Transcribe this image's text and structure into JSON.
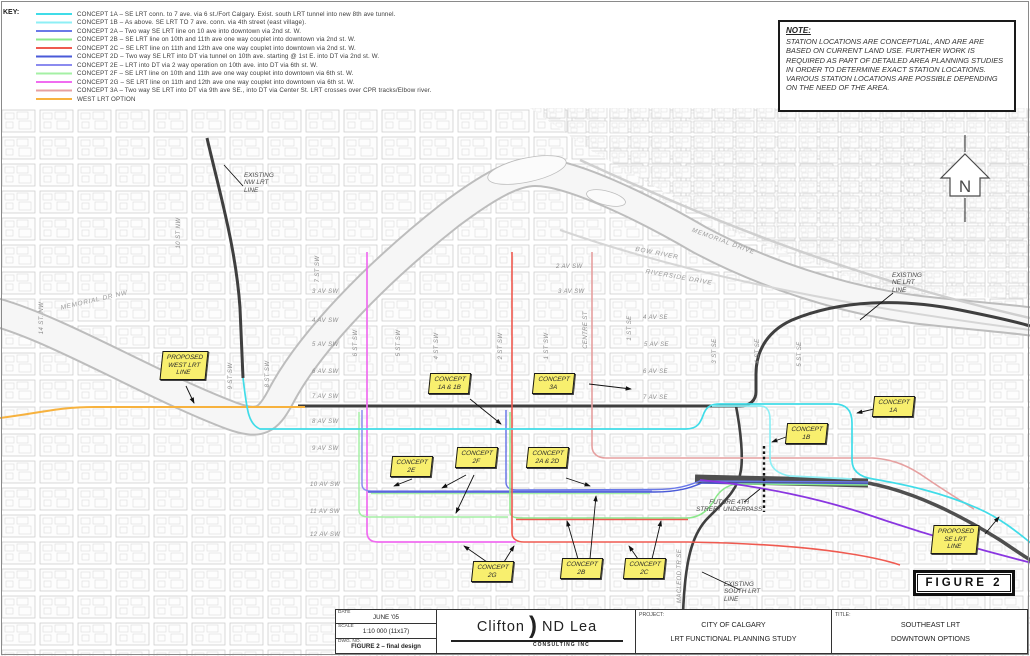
{
  "key": {
    "title": "KEY:",
    "items": [
      {
        "id": "1A",
        "color": "#40DCE8",
        "label": "CONCEPT 1A – SE LRT conn. to 7 ave. via 6 st./Fort Calgary. Exist. south LRT tunnel into new 8th ave tunnel."
      },
      {
        "id": "1B",
        "color": "#8EEFF5",
        "label": "CONCEPT 1B – As above. SE LRT TO 7 ave. conn. via 4th street (east village)."
      },
      {
        "id": "2A",
        "color": "#6A79E8",
        "label": "CONCEPT 2A – Two way SE LRT line on 10 ave into downtown via 2nd st. W."
      },
      {
        "id": "2B",
        "color": "#8BE88B",
        "label": "CONCEPT 2B – SE LRT line on 10th and 11th ave one way couplet into downtown via 2nd st. W."
      },
      {
        "id": "2C",
        "color": "#EF5A50",
        "label": "CONCEPT 2C – SE LRT line on 11th and 12th ave one way couplet into downtown via 2nd st. W."
      },
      {
        "id": "2D",
        "color": "#4A5AD8",
        "label": "CONCEPT 2D – Two way SE LRT into DT via tunnel on 10th ave. starting @ 1st E. into DT via 2nd st. W."
      },
      {
        "id": "2E",
        "color": "#8B8BEF",
        "label": "CONCEPT 2E – LRT into DT via 2 way operation on 10th ave. into DT via 6th st. W."
      },
      {
        "id": "2F",
        "color": "#A5F0A5",
        "label": "CONCEPT 2F – SE LRT line on 10th and 11th ave one way couplet into downtown via 6th st. W."
      },
      {
        "id": "2G",
        "color": "#F06CF0",
        "label": "CONCEPT 2G – SE LRT line on 11th and 12th ave one way couplet into downtown via 6th st. W."
      },
      {
        "id": "3A",
        "color": "#E6A0A0",
        "label": "CONCEPT 3A – Two way SE LRT into DT via 9th ave SE., into DT via Center St.  LRT crosses over CPR tracks/Elbow river."
      },
      {
        "id": "WEST",
        "color": "#F7B23E",
        "label": "WEST LRT OPTION"
      }
    ]
  },
  "note": {
    "title": "NOTE:",
    "body": "STATION LOCATIONS ARE CONCEPTUAL, AND ARE ARE BASED ON CURRENT LAND USE. FURTHER WORK IS REQUIRED AS PART OF DETAILED AREA PLANNING STUDIES IN ORDER TO DETERMINE EXACT STATION LOCATIONS. VARIOUS STATION LOCATIONS ARE POSSIBLE DEPENDING ON THE NEED OF THE AREA."
  },
  "north": {
    "letter": "N"
  },
  "map": {
    "colors": {
      "existing": "#3f3f3f",
      "cpr_band": "#4f4f4f",
      "se_line": "#8A36E0",
      "dotted": "#111111"
    },
    "figure_label": "FIGURE 2",
    "avenues_sw": [
      "3 AV SW",
      "4 AV SW",
      "5 AV SW",
      "6 AV SW",
      "7 AV SW",
      "8 AV SW",
      "9 AV SW",
      "10 AV SW",
      "11 AV SW",
      "12 AV SW"
    ],
    "avenues_right": [
      "2 AV SW",
      "3 AV SW"
    ],
    "avenues_se": [
      "4 AV SE",
      "5 AV SE",
      "6 AV SE",
      "7 AV SE"
    ],
    "streets": {
      "st14nw": "14 ST. NW",
      "st10nw": "10 ST NW",
      "st9sw": "9 ST SW",
      "st8sw": "8 ST SW",
      "st7sw": "7 ST SW",
      "st6sw": "6 ST SW",
      "st5sw": "5 ST SW",
      "st4sw": "4 ST SW",
      "st2sw": "2 ST SW",
      "st1sw": "1 ST SW",
      "centre": "CENTRE ST",
      "st1se": "1 ST SE",
      "st3se": "3 ST SE",
      "st4se": "4 ST SE",
      "st5se": "5 ST SE",
      "macleod": "MACLEOD TR SE",
      "memorial_nw": "MEMORIAL DR NW",
      "bow_river": "BOW RIVER",
      "memorial": "MEMORIAL DRIVE",
      "riverside": "RIVERSIDE DRIVE"
    },
    "callouts": {
      "c1a1b": "CONCEPT\n1A & 1B",
      "c3a": "CONCEPT\n3A",
      "c1a": "CONCEPT\n1A",
      "c1b": "CONCEPT\n1B",
      "c2e": "CONCEPT\n2E",
      "c2f": "CONCEPT\n2F",
      "c2a2d": "CONCEPT\n2A & 2D",
      "c2g": "CONCEPT\n2G",
      "c2b": "CONCEPT\n2B",
      "c2c": "CONCEPT\n2C",
      "west": "PROPOSED\nWEST LRT\nLINE",
      "se": "PROPOSED\nSE LRT\nLINE"
    },
    "notes": {
      "nw": "EXISTING\nNW LRT\nLINE",
      "ne": "EXISTING\nNE LRT\nLINE",
      "south": "EXISTING\nSOUTH LRT\nLINE",
      "underpass": "FUTURE 4TH\nSTREET UNDERPASS"
    }
  },
  "titleblock": {
    "date_label": "DATE",
    "date": "JUNE '05",
    "scale_label": "SCALE",
    "scale": "1:10 000 (11x17)",
    "dwg_label": "DWG. NO.",
    "dwg": "FIGURE 2 – final design",
    "logo_left": "Clifton",
    "logo_paren": ")",
    "logo_right": "ND Lea",
    "logo_sub": "CONSULTING INC",
    "project_label": "PROJECT:",
    "project_line1": "CITY OF CALGARY",
    "project_line2": "LRT FUNCTIONAL PLANNING STUDY",
    "title_label": "TITLE:",
    "title_line1": "SOUTHEAST LRT",
    "title_line2": "DOWNTOWN OPTIONS"
  }
}
